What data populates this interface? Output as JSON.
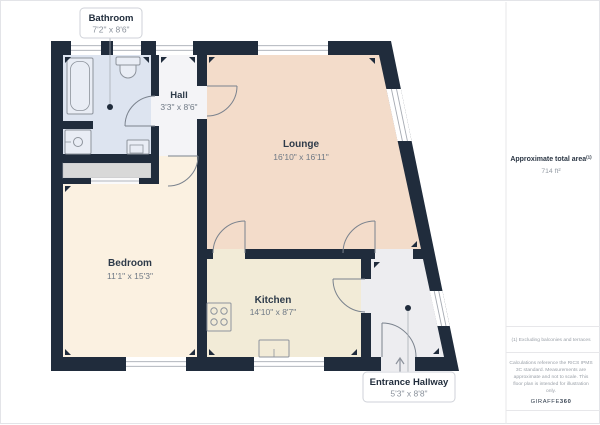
{
  "plan": {
    "rooms": {
      "bathroom": {
        "name": "Bathroom",
        "dims": "7'2\" x 8'6\""
      },
      "hall": {
        "name": "Hall",
        "dims": "3'3\" x 8'6\""
      },
      "lounge": {
        "name": "Lounge",
        "dims": "16'10\" x 16'11\""
      },
      "bedroom": {
        "name": "Bedroom",
        "dims": "11'1\" x 15'3\""
      },
      "kitchen": {
        "name": "Kitchen",
        "dims": "14'10\" x 8'7\""
      },
      "entrance": {
        "name": "Entrance Hallway",
        "dims": "5'3\" x 8'8\""
      }
    },
    "colors": {
      "wall": "#202c3c",
      "lounge_floor": "#f3dcca",
      "bedroom_floor": "#fbf1e1",
      "kitchen_floor": "#f2ebd7",
      "bathroom_floor": "#dde4f0",
      "hall_floor": "#f4f4f7",
      "entrance_floor": "#ededf0",
      "closet": "#d8d8d8",
      "fixture_line": "#8d939c"
    }
  },
  "side_panel": {
    "total_area_label": "Approximate total area",
    "total_area_sup": "(1)",
    "total_area_value": "714 ft²",
    "footnote": "(1) Excluding balconies and terraces",
    "disclaimer_lines": [
      "Calculations reference the RICS IPMS",
      "3C standard. Measurements are",
      "approximate and not to scale. This",
      "floor plan is intended for illustration",
      "only."
    ],
    "brand_name": "GIRAFFE",
    "brand_suffix": "360"
  }
}
